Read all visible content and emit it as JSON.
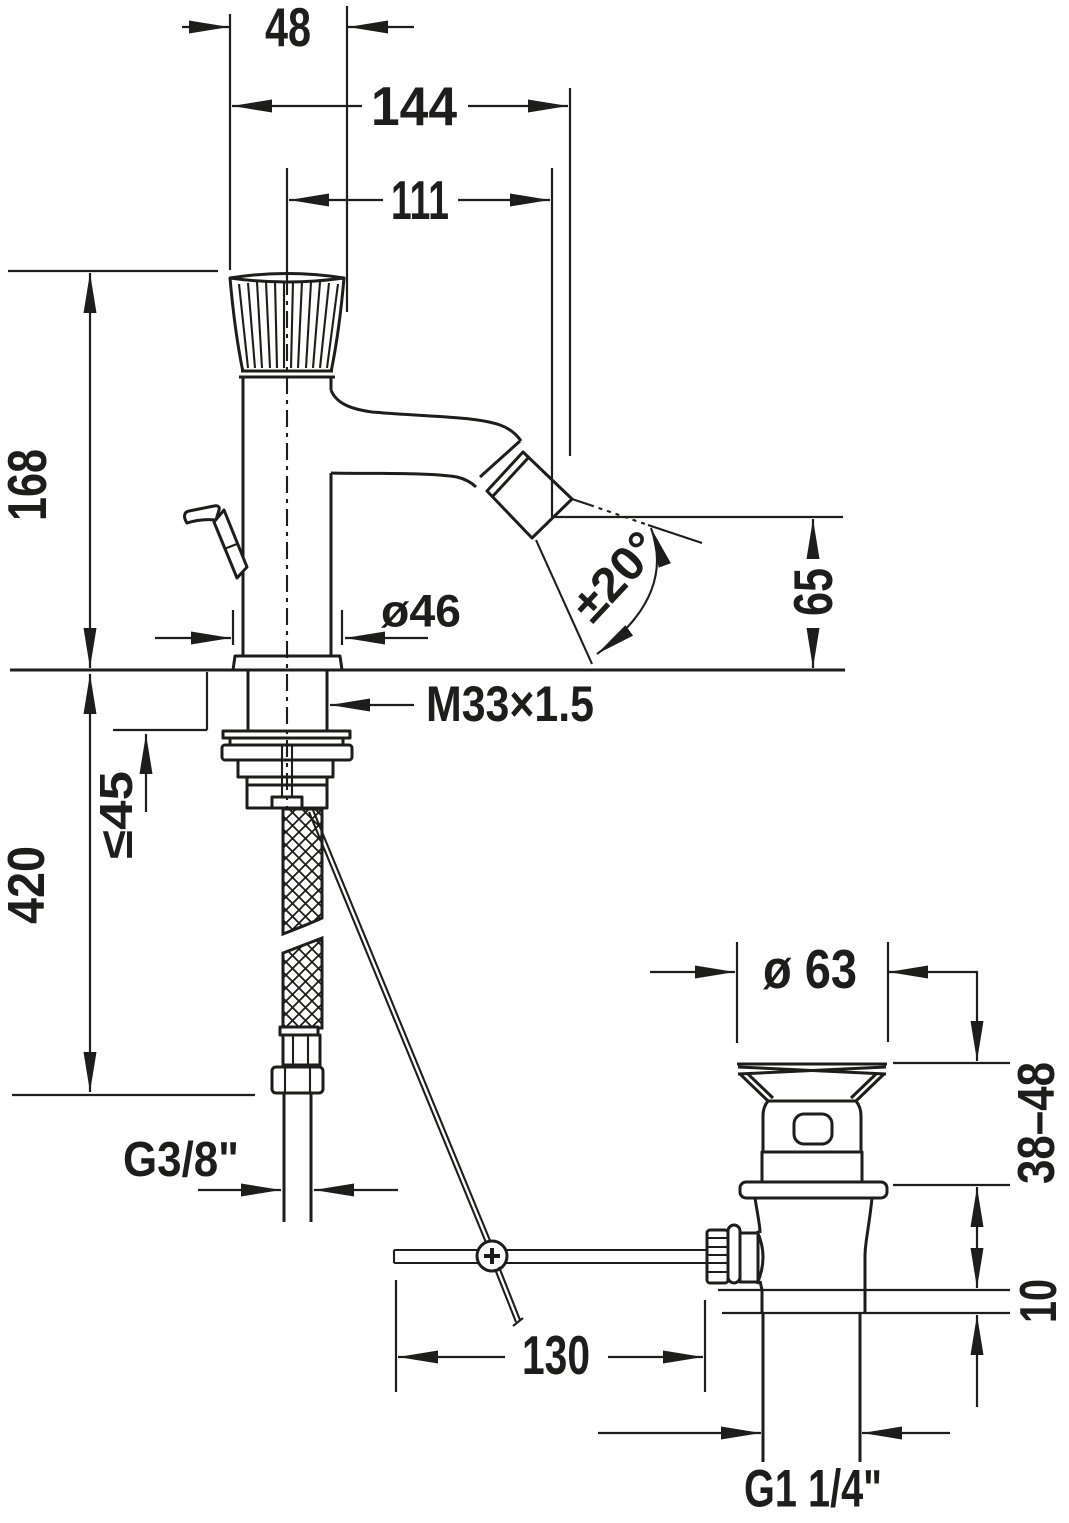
{
  "drawing": {
    "kind": "technical-dimension-drawing",
    "subject": "bidet single-lever mixer with pop-up waste",
    "meta": {
      "background": "#ffffff",
      "line_color": "#1d1d1b"
    },
    "labels": {
      "handle_width": "48",
      "reach_total": "144",
      "reach_spout": "111",
      "height_above_deck": "168",
      "base_diameter": "ø46",
      "spray_angle": "±20°",
      "outlet_height": "65",
      "shank_thread": "M33×1.5",
      "max_deck_thickness": "≤45",
      "hose_length": "420",
      "supply_thread": "G3/8\"",
      "waste_diameter": "ø 63",
      "waste_deck_range": "38–48",
      "waste_collar_height": "10",
      "rod_reach": "130",
      "waste_thread": "G1 1/4\""
    }
  }
}
